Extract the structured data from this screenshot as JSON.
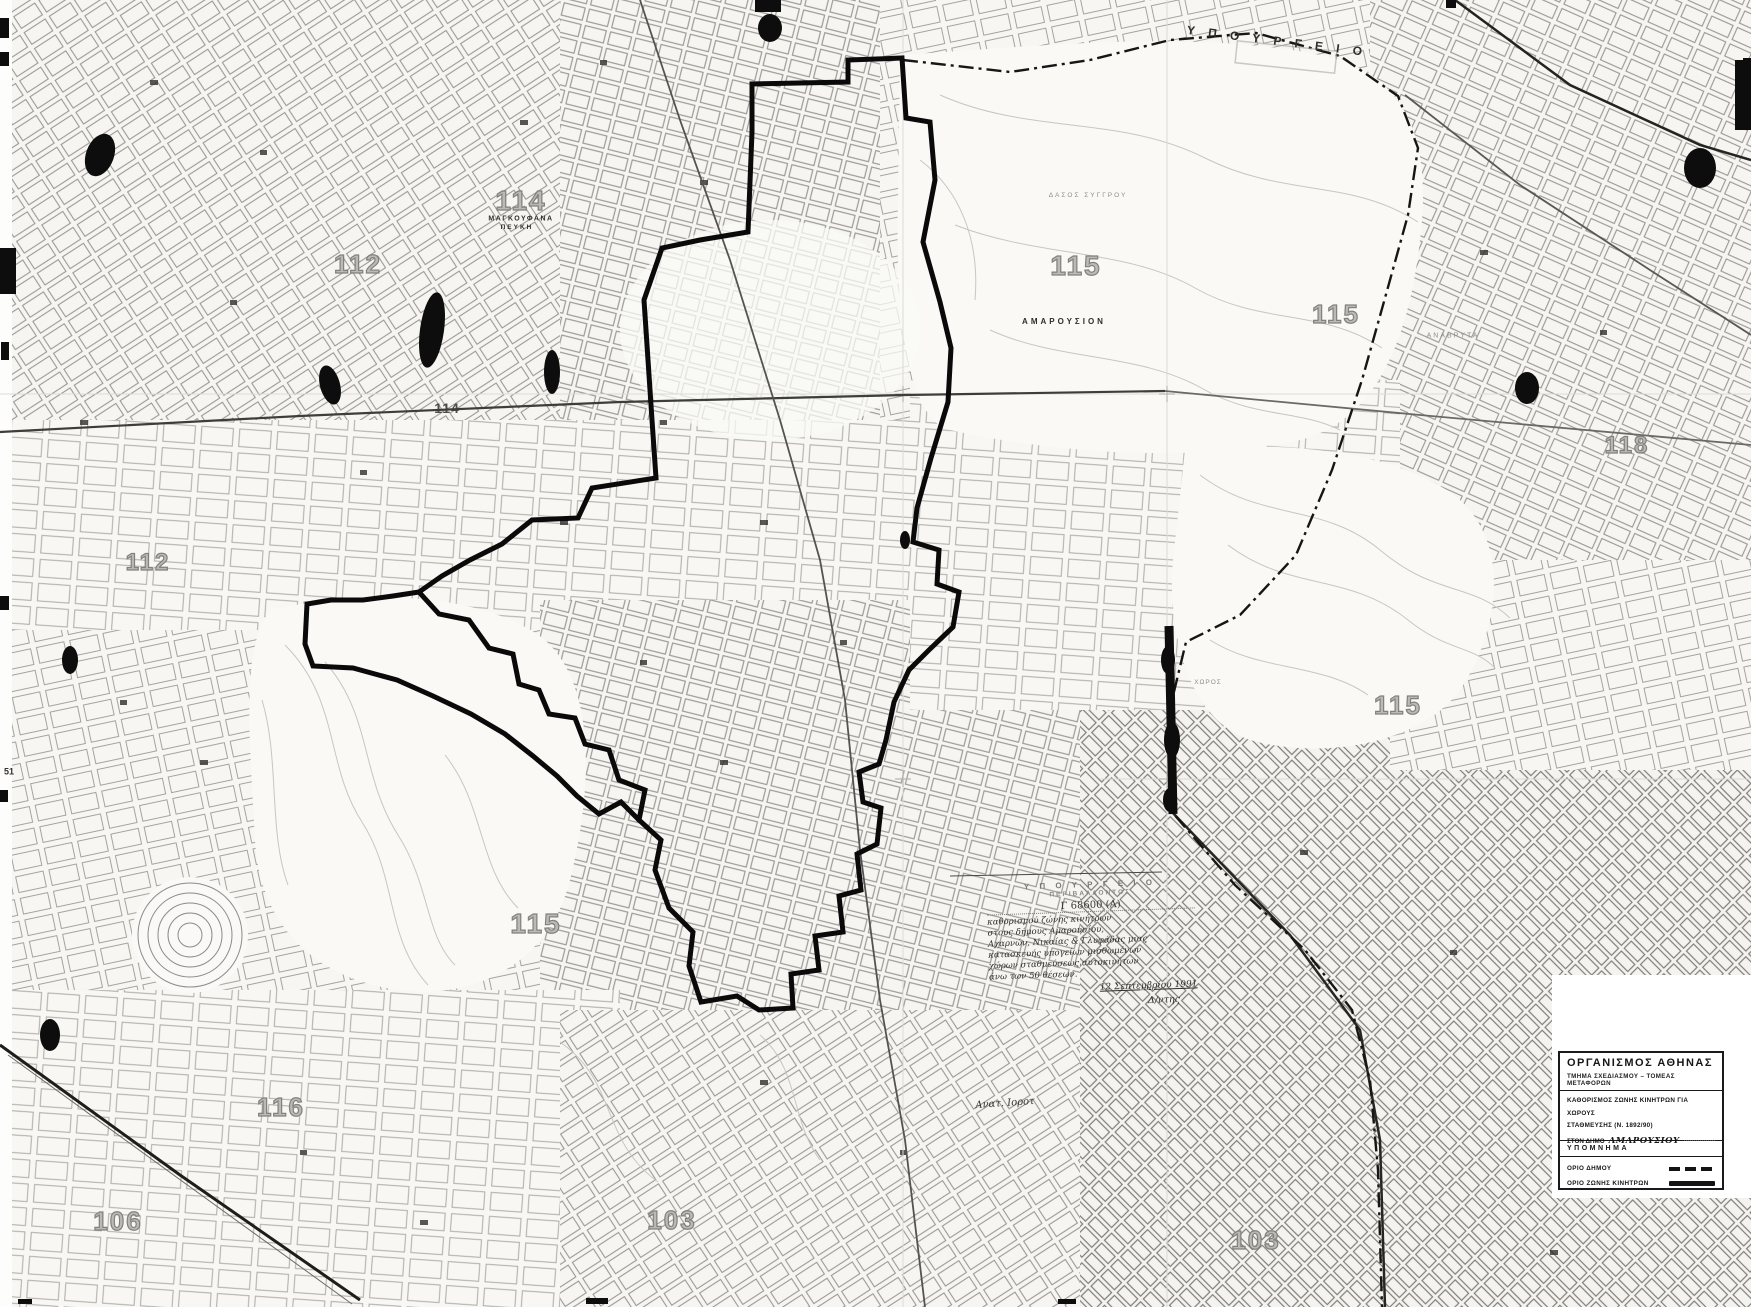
{
  "colors": {
    "paper": "#f8f7f4",
    "ink": "#141414",
    "zone_boundary": "#0a0a0a",
    "label_gray": "#8a8884"
  },
  "map": {
    "sheet_labels": [
      {
        "text": "114",
        "x": 521,
        "y": 201,
        "size": 28,
        "style": "outline"
      },
      {
        "text": "112",
        "x": 358,
        "y": 264,
        "size": 26,
        "style": "outline"
      },
      {
        "text": "115",
        "x": 1076,
        "y": 266,
        "size": 28,
        "style": "outline"
      },
      {
        "text": "115",
        "x": 1336,
        "y": 314,
        "size": 26,
        "style": "outline"
      },
      {
        "text": "114",
        "x": 447,
        "y": 408,
        "size": 14,
        "style": "dark"
      },
      {
        "text": "118",
        "x": 1627,
        "y": 446,
        "size": 24,
        "style": "outline"
      },
      {
        "text": "112",
        "x": 148,
        "y": 563,
        "size": 24,
        "style": "outline"
      },
      {
        "text": "115",
        "x": 1398,
        "y": 705,
        "size": 26,
        "style": "outline"
      },
      {
        "text": "115",
        "x": 536,
        "y": 924,
        "size": 28,
        "style": "outline"
      },
      {
        "text": "116",
        "x": 281,
        "y": 1107,
        "size": 26,
        "style": "outline"
      },
      {
        "text": "106",
        "x": 118,
        "y": 1221,
        "size": 26,
        "style": "outline"
      },
      {
        "text": "103",
        "x": 672,
        "y": 1220,
        "size": 26,
        "style": "outline"
      },
      {
        "text": "103",
        "x": 1256,
        "y": 1240,
        "size": 26,
        "style": "outline"
      }
    ],
    "place_labels": [
      {
        "text": "Υ Π Ο Υ Ρ Γ Ε Ι Ο",
        "x": 1277,
        "y": 41,
        "size": 12,
        "spacing": 5,
        "rotate": 7,
        "style": "spaced-dark"
      },
      {
        "text": "ΜΑΓΚΟΥΦΑΝΑ",
        "x": 521,
        "y": 219,
        "size": 7,
        "spacing": 1.5,
        "style": "spaced-dark"
      },
      {
        "text": "ΠΕΥΚΗ",
        "x": 517,
        "y": 228,
        "size": 6.5,
        "spacing": 2,
        "style": "spaced-dark"
      },
      {
        "text": "ΑΜΑΡΟΥΣΙΟΝ",
        "x": 1064,
        "y": 322,
        "size": 8,
        "spacing": 3,
        "style": "spaced-dark"
      },
      {
        "text": "ΑΝΑΒΡΥΤΑ",
        "x": 1453,
        "y": 336,
        "size": 7,
        "spacing": 2,
        "style": "faint"
      },
      {
        "text": "ΔΑΣΟΣ ΣΥΓΓΡΟΥ",
        "x": 1088,
        "y": 196,
        "size": 6.5,
        "spacing": 2,
        "style": "faint"
      },
      {
        "text": "ΧΩΡΟΣ",
        "x": 1208,
        "y": 683,
        "size": 6.5,
        "spacing": 1,
        "style": "faint"
      },
      {
        "text": "Ανατ. Ιοροτ",
        "x": 1005,
        "y": 1104,
        "size": 10,
        "rotate": -4,
        "style": "hand"
      },
      {
        "text": "51",
        "x": 9,
        "y": 772,
        "size": 9,
        "style": "dark"
      }
    ]
  },
  "annotation": {
    "stamp_line1": "Υ Π Ο Υ Ρ Γ Ε Ι Ο",
    "stamp_line2": "ΠΕΡΙΒΑΛΛΟΝΤΟΣ",
    "ref": "Γ 68600 (Α)",
    "hand_lines": [
      "καθορισμού ζώνης κινήτρων",
      "στους δήμους Αμαρουσίου,",
      "Αχαρνών, Νικαίας & Γλυφάδας μιας",
      "κατασκευής υπογείων μισθωμένων",
      "χώρων σταθμεύσεως αυτοκινήτων",
      "άνω των 50 θέσεων."
    ],
    "date": "12 Σεπτεμβρίου 1991",
    "signature": "Δ/ντης"
  },
  "legend": {
    "org": "ΟΡΓΑΝΙΣΜΟΣ ΑΘΗΝΑΣ",
    "dept": "ΤΜΗΜΑ ΣΧΕΔΙΑΣΜΟΥ – ΤΟΜΕΑΣ ΜΕΤΑΦΟΡΩΝ",
    "title_line1": "ΚΑΘΟΡΙΣΜΟΣ ΖΩΝΗΣ ΚΙΝΗΤΡΩΝ ΓΙΑ ΧΩΡΟΥΣ",
    "title_line2": "ΣΤΑΘΜΕΥΣΗΣ (Ν. 1892/90)",
    "municipality_prefix": "ΣΤΟΝ ΔΗΜΟ",
    "municipality_value": "ΑΜΑΡΟΥΣΙΟΥ",
    "section_header": "ΥΠΟΜΝΗΜΑ",
    "entries": [
      {
        "label": "ΟΡΙΟ ΔΗΜΟΥ",
        "symbol": "dashed"
      },
      {
        "label": "ΟΡΙΟ ΖΩΝΗΣ ΚΙΝΗΤΡΩΝ",
        "symbol": "solid"
      }
    ]
  }
}
